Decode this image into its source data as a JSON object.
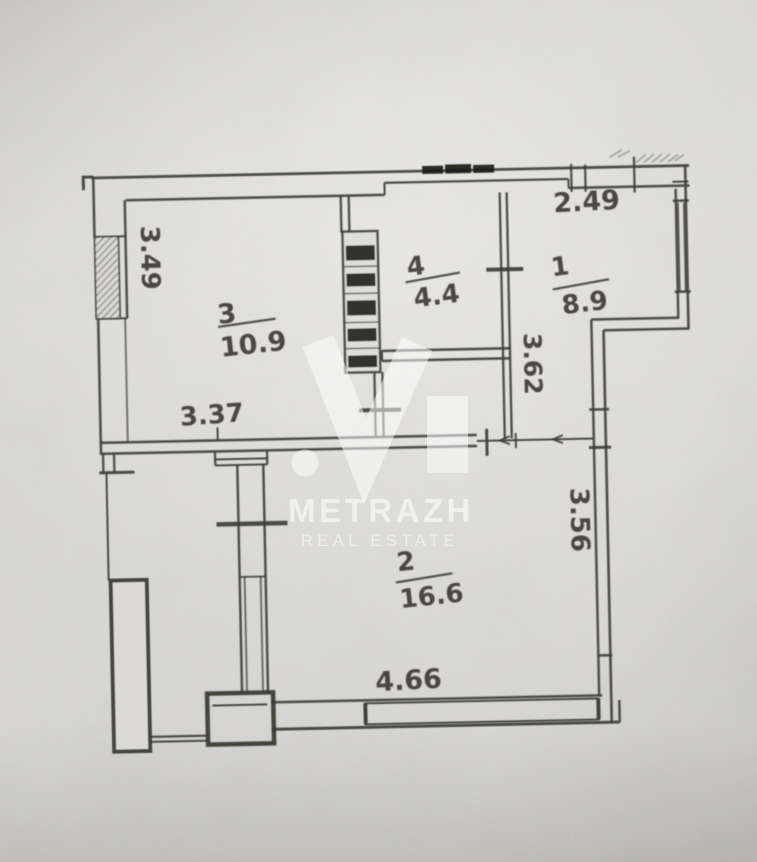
{
  "plan": {
    "rooms": [
      {
        "number": "3",
        "area": "10.9"
      },
      {
        "number": "4",
        "area": "4.4"
      },
      {
        "number": "1",
        "area": "8.9"
      },
      {
        "number": "2",
        "area": "16.6"
      }
    ],
    "dimensions": {
      "left_wall_height": "3.49",
      "room3_width": "3.37",
      "room1_width": "2.49",
      "room1_height": "3.62",
      "room2_height": "3.56",
      "room2_width": "4.66"
    }
  },
  "watermark": {
    "brand": "METRAZH",
    "tagline": "REAL ESTATE",
    "logo": "metrazh-dot-m-logo"
  },
  "colors": {
    "paper": "#d8d7d5",
    "ink": "#3e3d3a",
    "watermark": "#ffffff"
  }
}
